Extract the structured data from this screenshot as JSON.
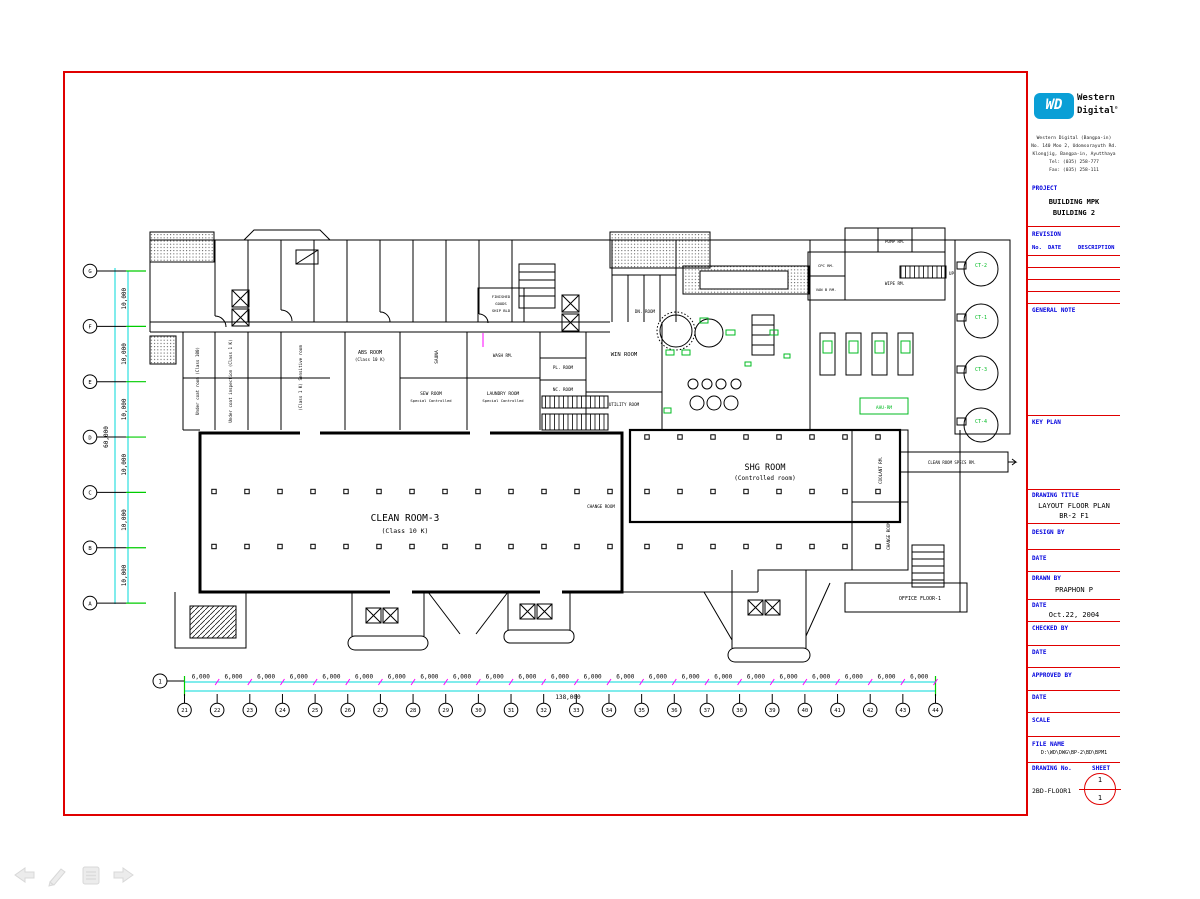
{
  "title_block": {
    "brand": {
      "wd": "WD",
      "name_line1": "Western",
      "name_line2": "Digital",
      "registered": "®"
    },
    "address_lines": [
      "Western Digital (Bangpa-in)",
      "No. 140 Moo 2, Udomsorayuth Rd.",
      "Klongjig, Bangpa-in, Ayutthaya",
      "Tel: (035) 258-777",
      "Fax: (035) 258-111"
    ],
    "project_label": "PROJECT",
    "project_line1": "BUILDING MPK",
    "project_line2": "BUILDING 2",
    "revision_label": "REVISION",
    "rev_cols": {
      "no": "No.",
      "date": "DATE",
      "desc": "DESCRIPTION"
    },
    "general_note_label": "GENERAL NOTE",
    "key_plan_label": "KEY PLAN",
    "drawing_title_label": "DRAWING TITLE",
    "drawing_title_line1": "LAYOUT FLOOR PLAN",
    "drawing_title_line2": "BR-2 F1",
    "design_by_label": "DESIGN BY",
    "date_label": "DATE",
    "drawn_by_label": "DRAWN BY",
    "drawn_by_value": "PRAPHON P",
    "drawn_date_value": "Oct.22, 2004",
    "checked_by_label": "CHECKED BY",
    "approved_by_label": "APPROVED BY",
    "scale_label": "SCALE",
    "file_name_label": "FILE NAME",
    "file_name_value": "D:\\WD\\DWG\\BP-2\\BD\\BPM1",
    "drawing_no_label": "DRAWING No.",
    "drawing_no_value": "2BD-FLOOR1",
    "sheet_label": "SHEET",
    "sheet_top": "1",
    "sheet_bottom": "1"
  },
  "plan": {
    "grid": {
      "left_bubbles": [
        "G",
        "F",
        "E",
        "D",
        "C",
        "B",
        "A"
      ],
      "left_dim": "10,000",
      "left_total": "60,000",
      "bottom_bubbles": [
        "21",
        "22",
        "23",
        "24",
        "25",
        "26",
        "27",
        "28",
        "29",
        "30",
        "31",
        "32",
        "33",
        "34",
        "35",
        "36",
        "37",
        "38",
        "39",
        "40",
        "41",
        "42",
        "43",
        "44"
      ],
      "bottom_dim": "6,000",
      "bottom_total": "138,000",
      "row_bubble": "1"
    },
    "labels": {
      "clean_room_1": "CLEAN ROOM-3",
      "clean_room_2": "(Class 10 K)",
      "shg_1": "SHG ROOM",
      "shg_2": "(Controlled room)",
      "abs_1": "ABS ROOM",
      "abs_2": "(Class 10 K)",
      "sew_1": "SEW ROOM",
      "sew_2": "Special Controlled",
      "laundry_1": "LAUNDRY ROOM",
      "laundry_2": "Special Controlled",
      "under_coat_room": "Under coat room (Class 100)",
      "under_coat_insp": "Under coat inspection (Class 1 K)",
      "sensitive_room": "(Class 1 K) Sensitive room",
      "sauna": "SAUNA",
      "wash_rm": "WASH RM.",
      "win_room": "WIN ROOM",
      "pl_room": "PL. ROOM",
      "nc_room": "NC. ROOM",
      "utility_room": "UTILITY ROOM",
      "dn_room": "DN. ROOM",
      "finished_1": "FINISHED",
      "finished_2": "GOODS",
      "finished_3": "SHIP BLD",
      "pump_rm": "PUMP RM.",
      "wipe_rm": "WIPE RM.",
      "cpc_rm": "CPC RM.",
      "van_b_rm": "VAN B RM.",
      "up": "UP",
      "ahu_rm": "AHU-RM",
      "coolant_rm": "COOLANT RM.",
      "change_room_mid": "CHANGE ROOM",
      "change_room_right": "CHANGE ROOM",
      "office_floor": "OFFICE FLOOR-1",
      "cr_specs": "CLEAN ROOM SPECS RM.",
      "tanks": [
        "CT-2",
        "CT-1",
        "CT-3",
        "CT-4"
      ]
    }
  },
  "toolbar": {
    "icons": [
      "back-arrow",
      "pencil",
      "document",
      "forward-arrow"
    ]
  },
  "colors": {
    "frame_red": "#e00000",
    "label_blue": "#0000dd",
    "dim_cyan": "#00d8d8",
    "dim_magenta": "#ff00ff",
    "equip_green": "#00bb22",
    "wd_blue": "#0a9fd6"
  }
}
